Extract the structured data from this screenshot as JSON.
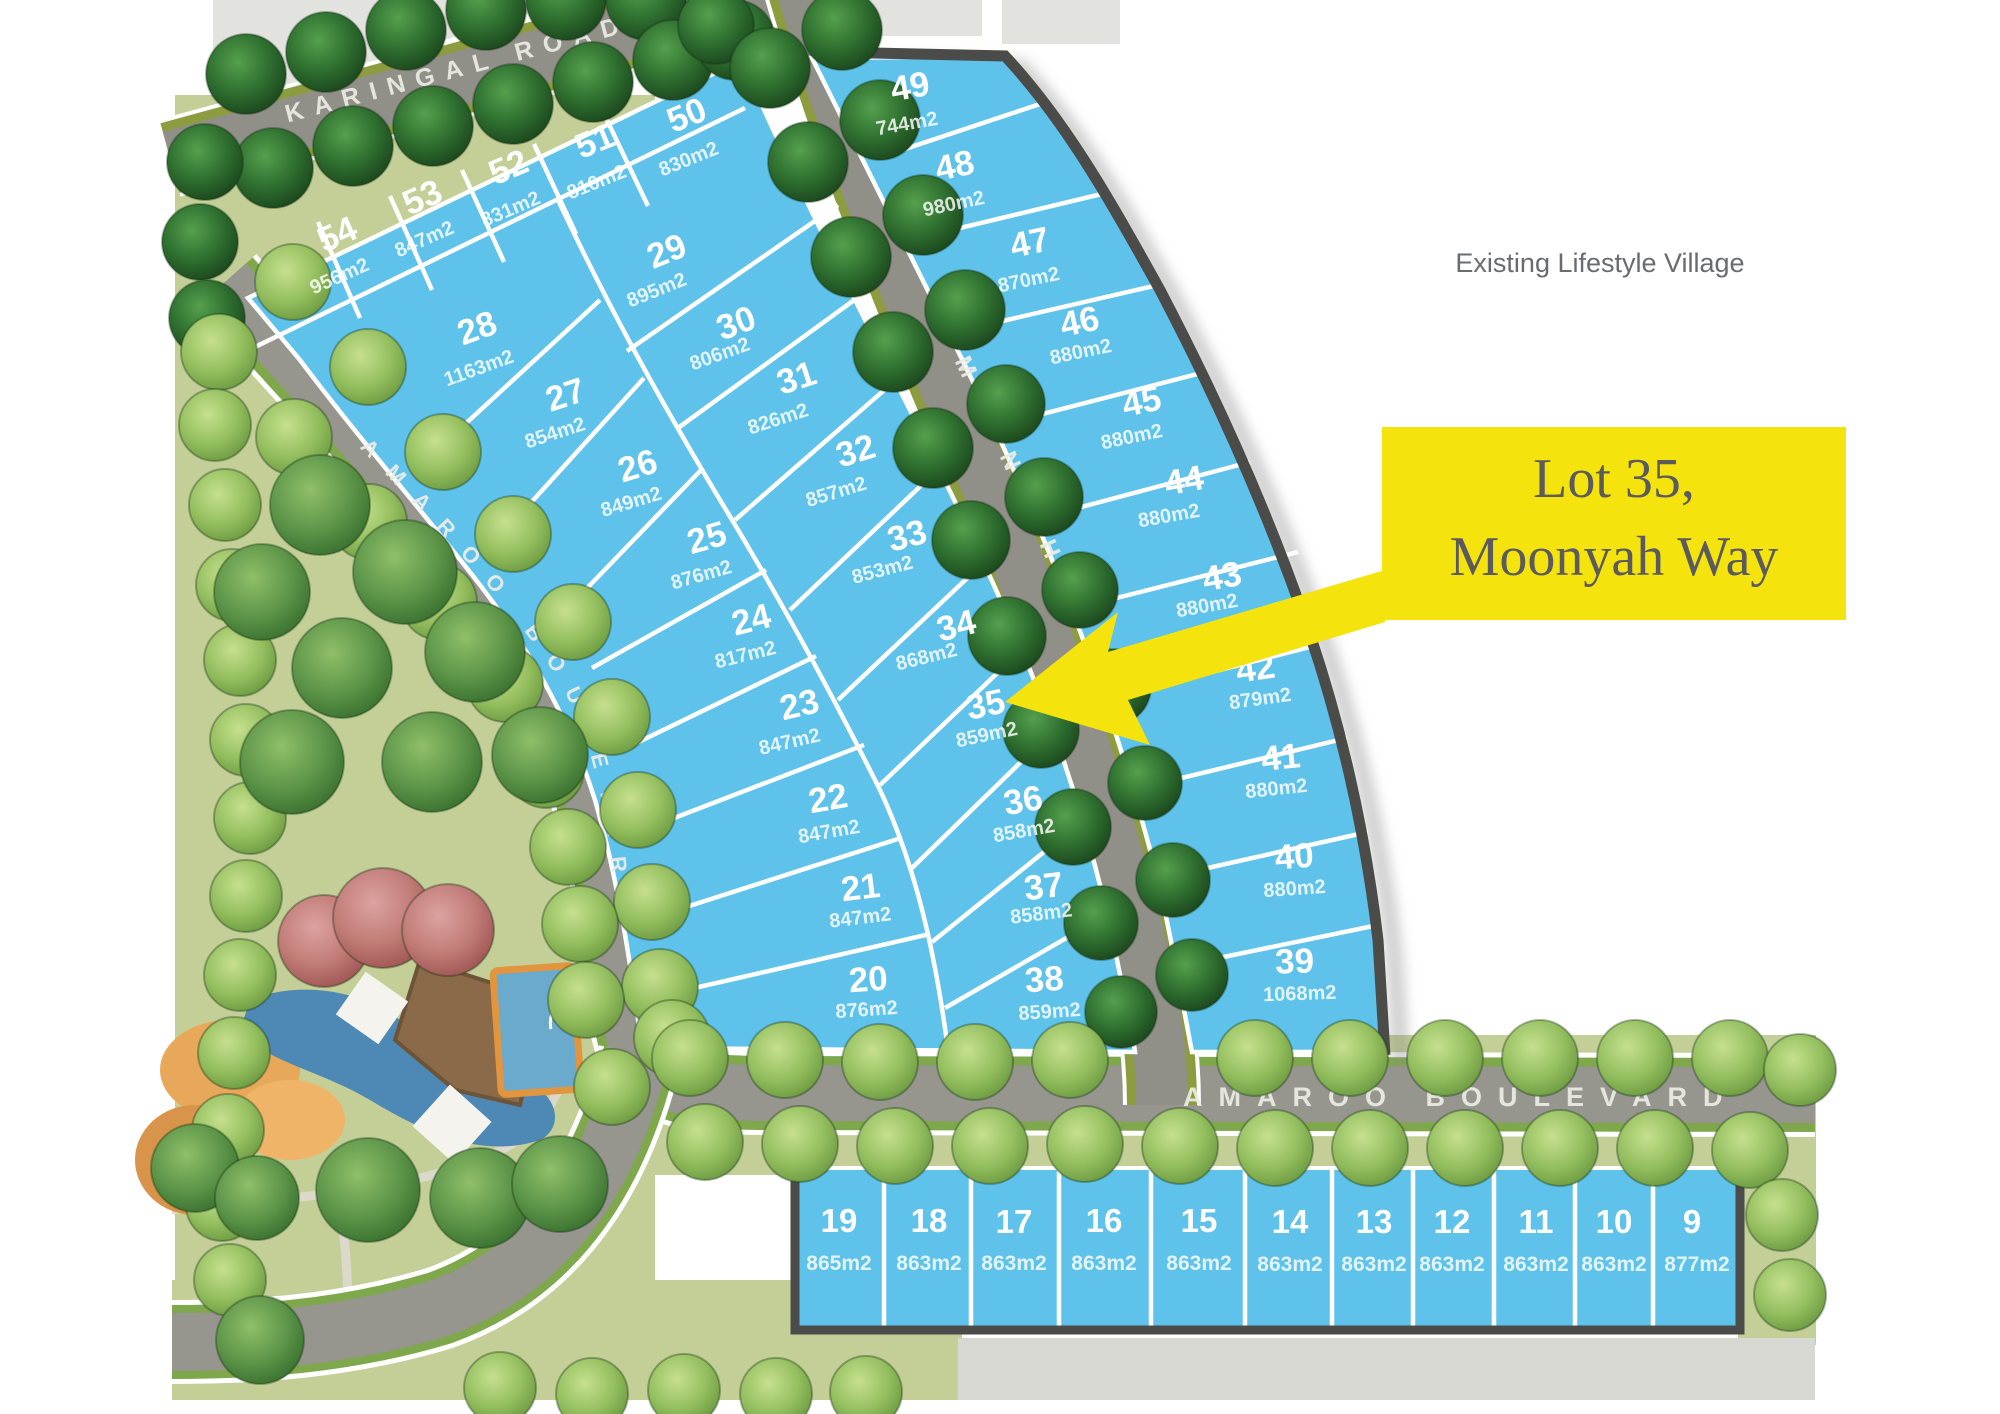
{
  "map": {
    "annotation": "Existing Lifestyle Village",
    "callout": {
      "line1": "Lot 35,",
      "line2": "Moonyah Way"
    },
    "streets": {
      "karingal": "KARINGAL ROAD",
      "moonyah": "MOONYAH",
      "amaroo_west": "AMAROO BOULEVARD",
      "amaroo_south": "AMAROO BOULEVARD"
    },
    "highlighted_lot": "35",
    "colors": {
      "lot_fill": "#5EC2EA",
      "boundary": "#4B4B49",
      "road": "#96958E",
      "verge_olive": "#8C9C3E",
      "verge_green": "#7FA84C",
      "grass": "#C3CF97",
      "callout_bg": "#F5E30E",
      "callout_text": "#5B5B5E",
      "annotation_text": "#6A6B6E",
      "arrow": "#F5E30E"
    },
    "lots": [
      {
        "number": "54",
        "area": "956m2"
      },
      {
        "number": "53",
        "area": "847m2"
      },
      {
        "number": "52",
        "area": "831m2"
      },
      {
        "number": "51",
        "area": "816m2"
      },
      {
        "number": "50",
        "area": "830m2"
      },
      {
        "number": "49",
        "area": "744m2"
      },
      {
        "number": "48",
        "area": "980m2"
      },
      {
        "number": "47",
        "area": "870m2"
      },
      {
        "number": "46",
        "area": "880m2"
      },
      {
        "number": "45",
        "area": "880m2"
      },
      {
        "number": "44",
        "area": "880m2"
      },
      {
        "number": "43",
        "area": "880m2"
      },
      {
        "number": "42",
        "area": "879m2"
      },
      {
        "number": "41",
        "area": "880m2"
      },
      {
        "number": "40",
        "area": "880m2"
      },
      {
        "number": "39",
        "area": "1068m2"
      },
      {
        "number": "29",
        "area": "895m2"
      },
      {
        "number": "30",
        "area": "806m2"
      },
      {
        "number": "31",
        "area": "826m2"
      },
      {
        "number": "32",
        "area": "857m2"
      },
      {
        "number": "33",
        "area": "853m2"
      },
      {
        "number": "34",
        "area": "868m2"
      },
      {
        "number": "35",
        "area": "859m2"
      },
      {
        "number": "36",
        "area": "858m2"
      },
      {
        "number": "37",
        "area": "858m2"
      },
      {
        "number": "38",
        "area": "859m2"
      },
      {
        "number": "28",
        "area": "1163m2"
      },
      {
        "number": "27",
        "area": "854m2"
      },
      {
        "number": "26",
        "area": "849m2"
      },
      {
        "number": "25",
        "area": "876m2"
      },
      {
        "number": "24",
        "area": "817m2"
      },
      {
        "number": "23",
        "area": "847m2"
      },
      {
        "number": "22",
        "area": "847m2"
      },
      {
        "number": "21",
        "area": "847m2"
      },
      {
        "number": "20",
        "area": "876m2"
      },
      {
        "number": "19",
        "area": "865m2"
      },
      {
        "number": "18",
        "area": "863m2"
      },
      {
        "number": "17",
        "area": "863m2"
      },
      {
        "number": "16",
        "area": "863m2"
      },
      {
        "number": "15",
        "area": "863m2"
      },
      {
        "number": "14",
        "area": "863m2"
      },
      {
        "number": "13",
        "area": "863m2"
      },
      {
        "number": "12",
        "area": "863m2"
      },
      {
        "number": "11",
        "area": "863m2"
      },
      {
        "number": "10",
        "area": "863m2"
      },
      {
        "number": "9",
        "area": "877m2"
      }
    ]
  }
}
